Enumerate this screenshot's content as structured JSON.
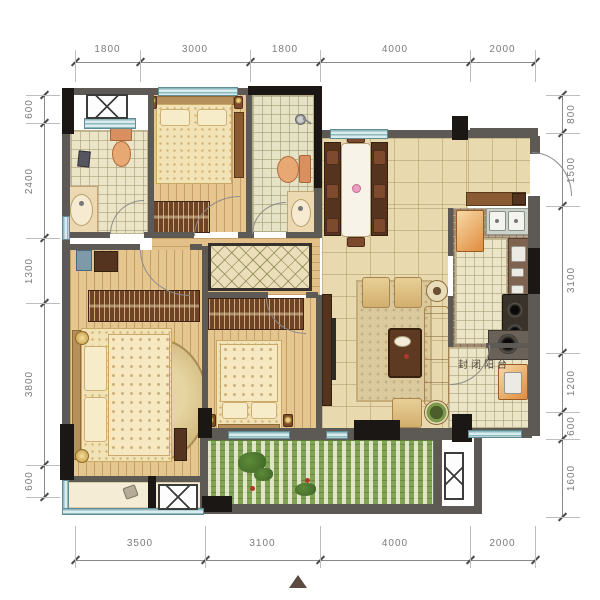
{
  "labels": {
    "enclosed_balcony": "封闭阳台"
  },
  "dimensions": {
    "top": [
      "1800",
      "3000",
      "1800",
      "4000",
      "2000"
    ],
    "bottom": [
      "3500",
      "3100",
      "4000",
      "2000"
    ],
    "left": [
      "600",
      "2400",
      "1300",
      "3800",
      "600"
    ],
    "right": [
      "800",
      "1500",
      "3100",
      "1200",
      "600",
      "1600"
    ]
  },
  "icons": {
    "north_arrow": "filled-triangle-up",
    "ac_unit": "crossed-box",
    "shower": "shower-head",
    "toilet": "toilet-bowl",
    "sink": "wash-basin"
  },
  "colors": {
    "wall": "#5d5955",
    "column": "#1a1714",
    "window": "#bcd9dc",
    "wood_floor": "#e6c68f",
    "tile_floor": "#e8d9ae",
    "garden": "#84a455",
    "furniture_gold": "#d9b878",
    "accent_orange": "#d98f5e"
  }
}
